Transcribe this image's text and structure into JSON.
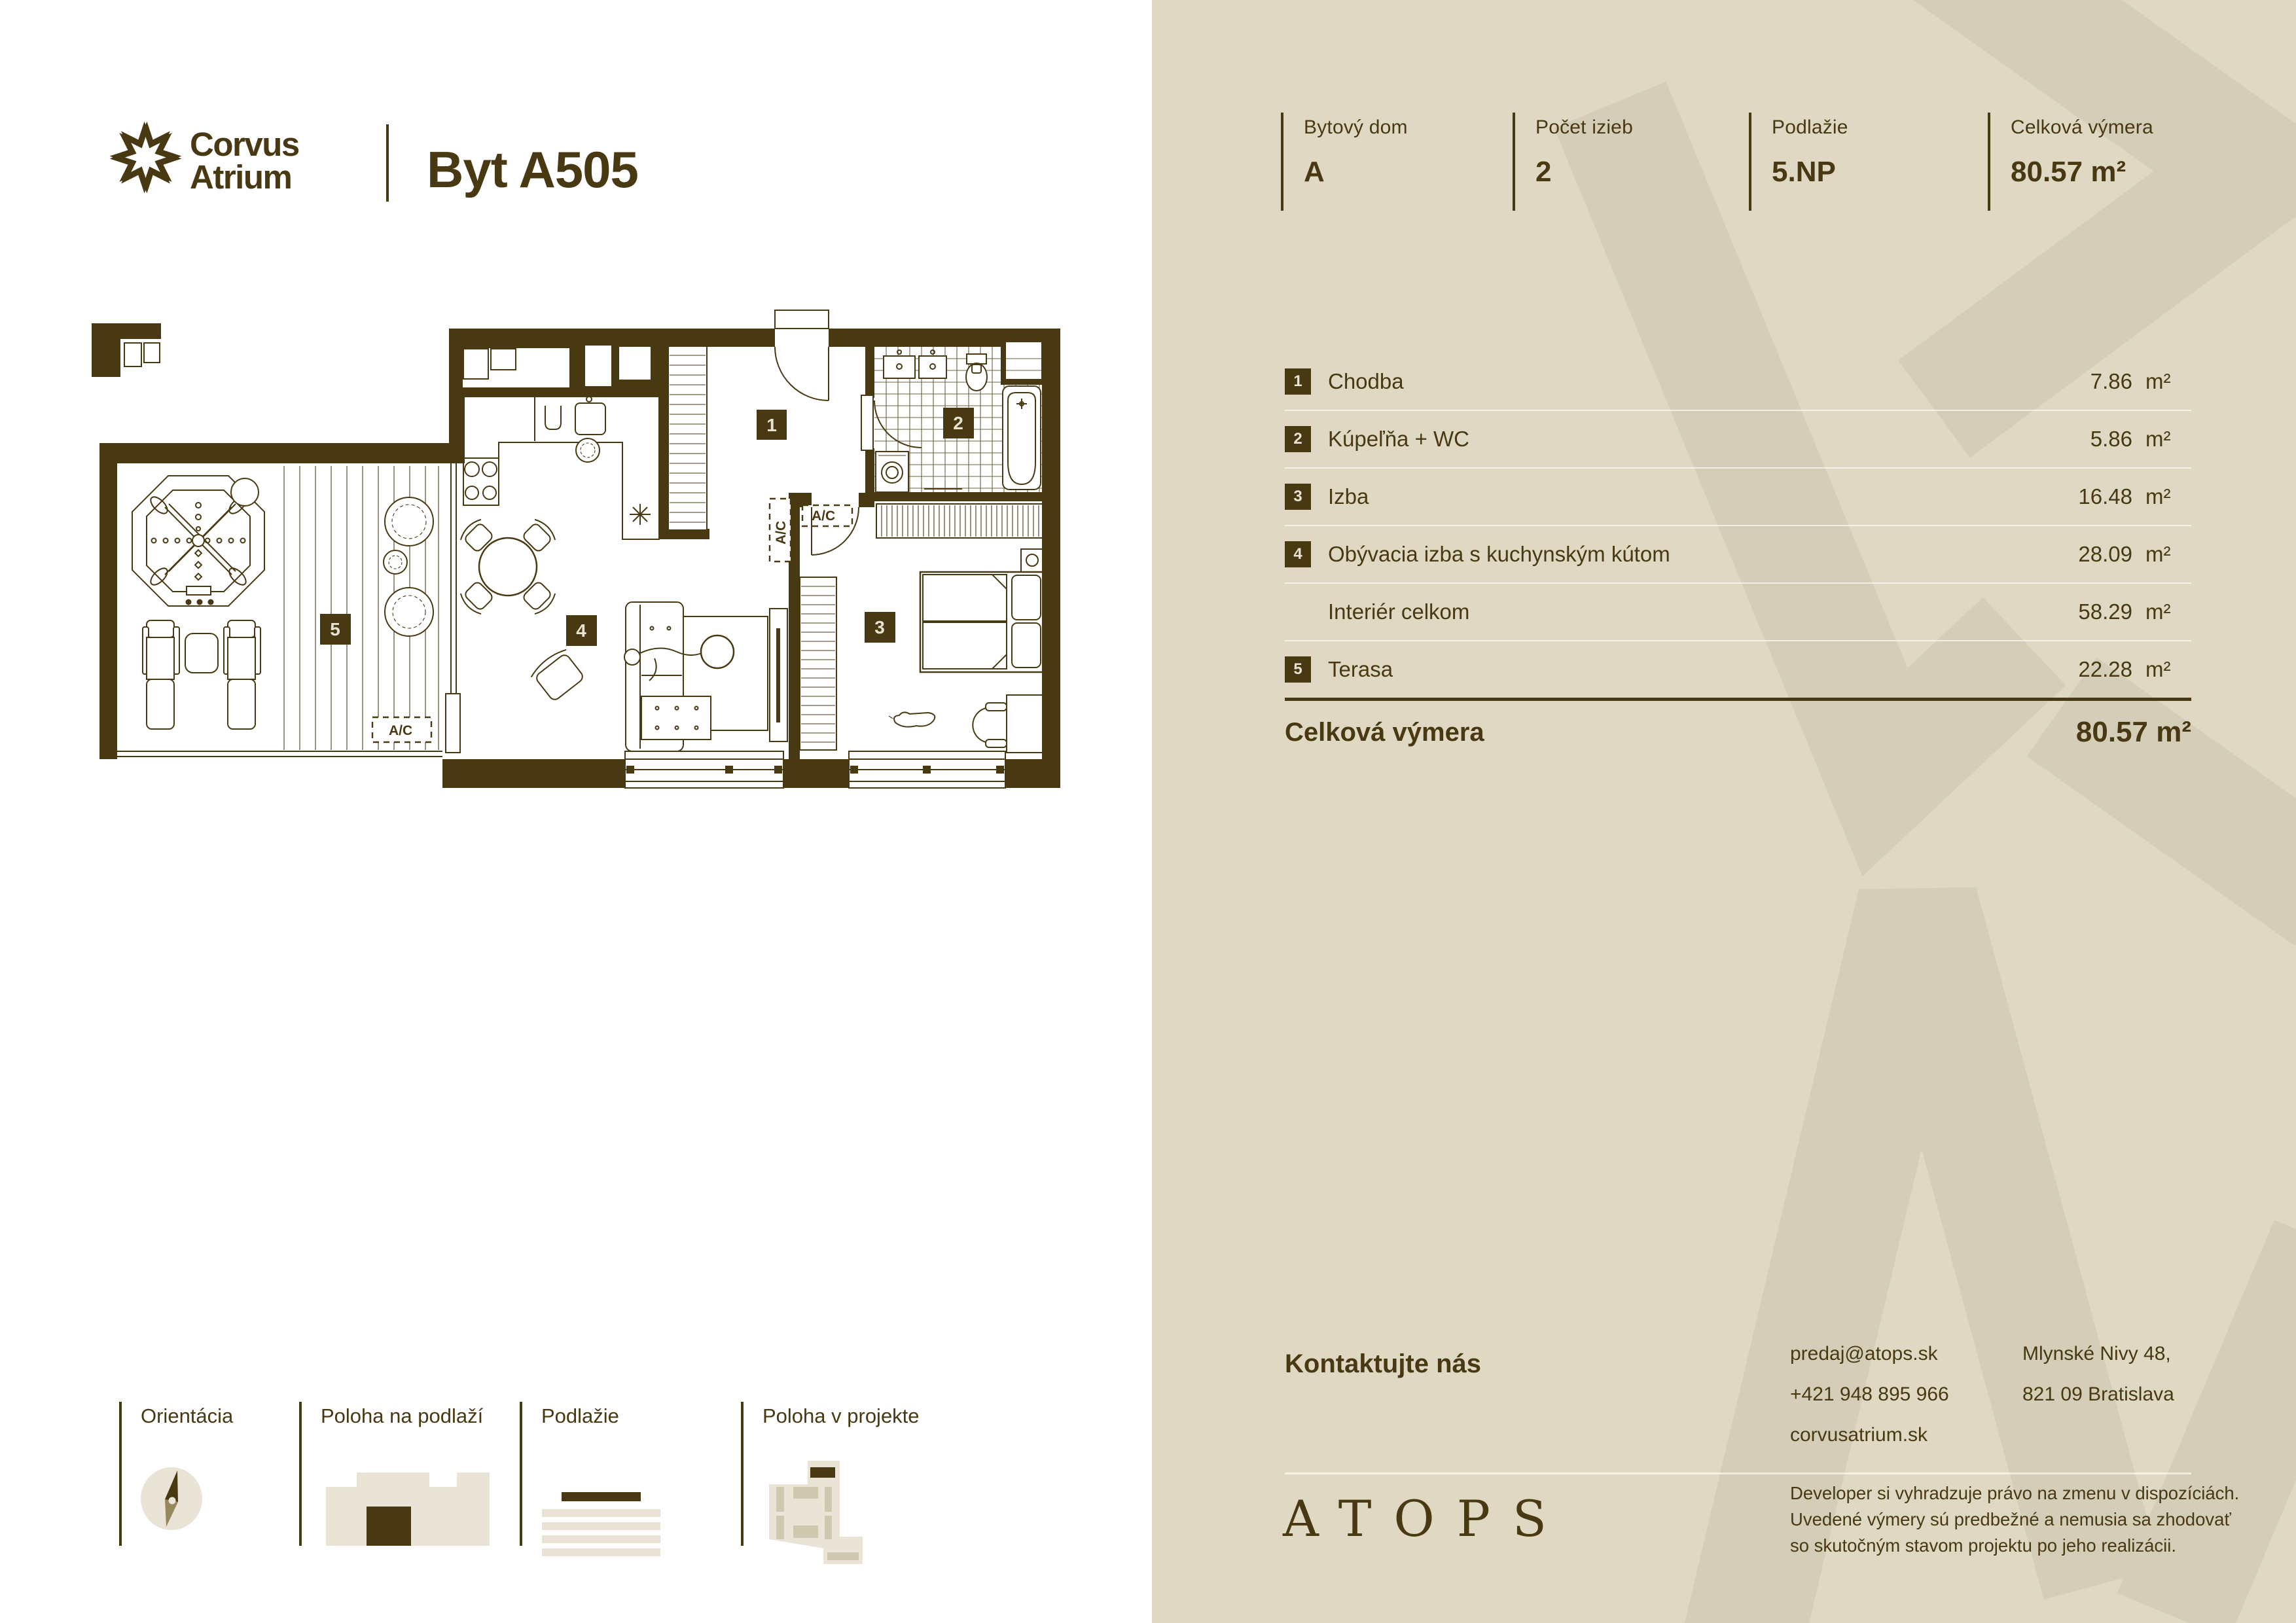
{
  "brand": {
    "name_line1": "Corvus",
    "name_line2": "Atrium"
  },
  "title": "Byt A505",
  "stats": [
    {
      "label": "Bytový dom",
      "value": "A"
    },
    {
      "label": "Počet izieb",
      "value": "2"
    },
    {
      "label": "Podlažie",
      "value": "5.NP"
    },
    {
      "label": "Celková výmera",
      "value": "80.57 m²"
    }
  ],
  "rooms": {
    "rows": [
      {
        "num": "1",
        "label": "Chodba",
        "value": "7.86",
        "unit": "m²"
      },
      {
        "num": "2",
        "label": "Kúpeľňa + WC",
        "value": "5.86",
        "unit": "m²"
      },
      {
        "num": "3",
        "label": "Izba",
        "value": "16.48",
        "unit": "m²"
      },
      {
        "num": "4",
        "label": "Obývacia izba s kuchynským kútom",
        "value": "28.09",
        "unit": "m²"
      },
      {
        "num": "",
        "label": "Interiér celkom",
        "value": "58.29",
        "unit": "m²"
      },
      {
        "num": "5",
        "label": "Terasa",
        "value": "22.28",
        "unit": "m²"
      }
    ],
    "total_label": "Celková výmera",
    "total_value": "80.57",
    "total_unit": "m²"
  },
  "contact": {
    "heading": "Kontaktujte nás",
    "email": "predaj@atops.sk",
    "phone": "+421 948 895 966",
    "web": "corvusatrium.sk",
    "address_line1": "Mlynské Nivy 48,",
    "address_line2": "821 09 Bratislava"
  },
  "footer": {
    "logo": "ATOPS",
    "disclaimer_line1": "Developer si vyhradzuje právo na zmenu v dispozíciách.",
    "disclaimer_line2": "Uvedené výmery sú predbežné a nemusia sa zhodovať",
    "disclaimer_line3": "so skutočným stavom projektu po jeho realizácii."
  },
  "legend": [
    {
      "label": "Orientácia"
    },
    {
      "label": "Poloha na podlaží"
    },
    {
      "label": "Podlažie"
    },
    {
      "label": "Poloha v projekte"
    }
  ],
  "plan": {
    "badges": [
      "1",
      "2",
      "3",
      "4",
      "5"
    ],
    "ac_label": "A/C"
  },
  "colors": {
    "brand_brown": "#483913",
    "panel_beige": "#dfd9c3",
    "watermark": "#d4cdb7"
  }
}
